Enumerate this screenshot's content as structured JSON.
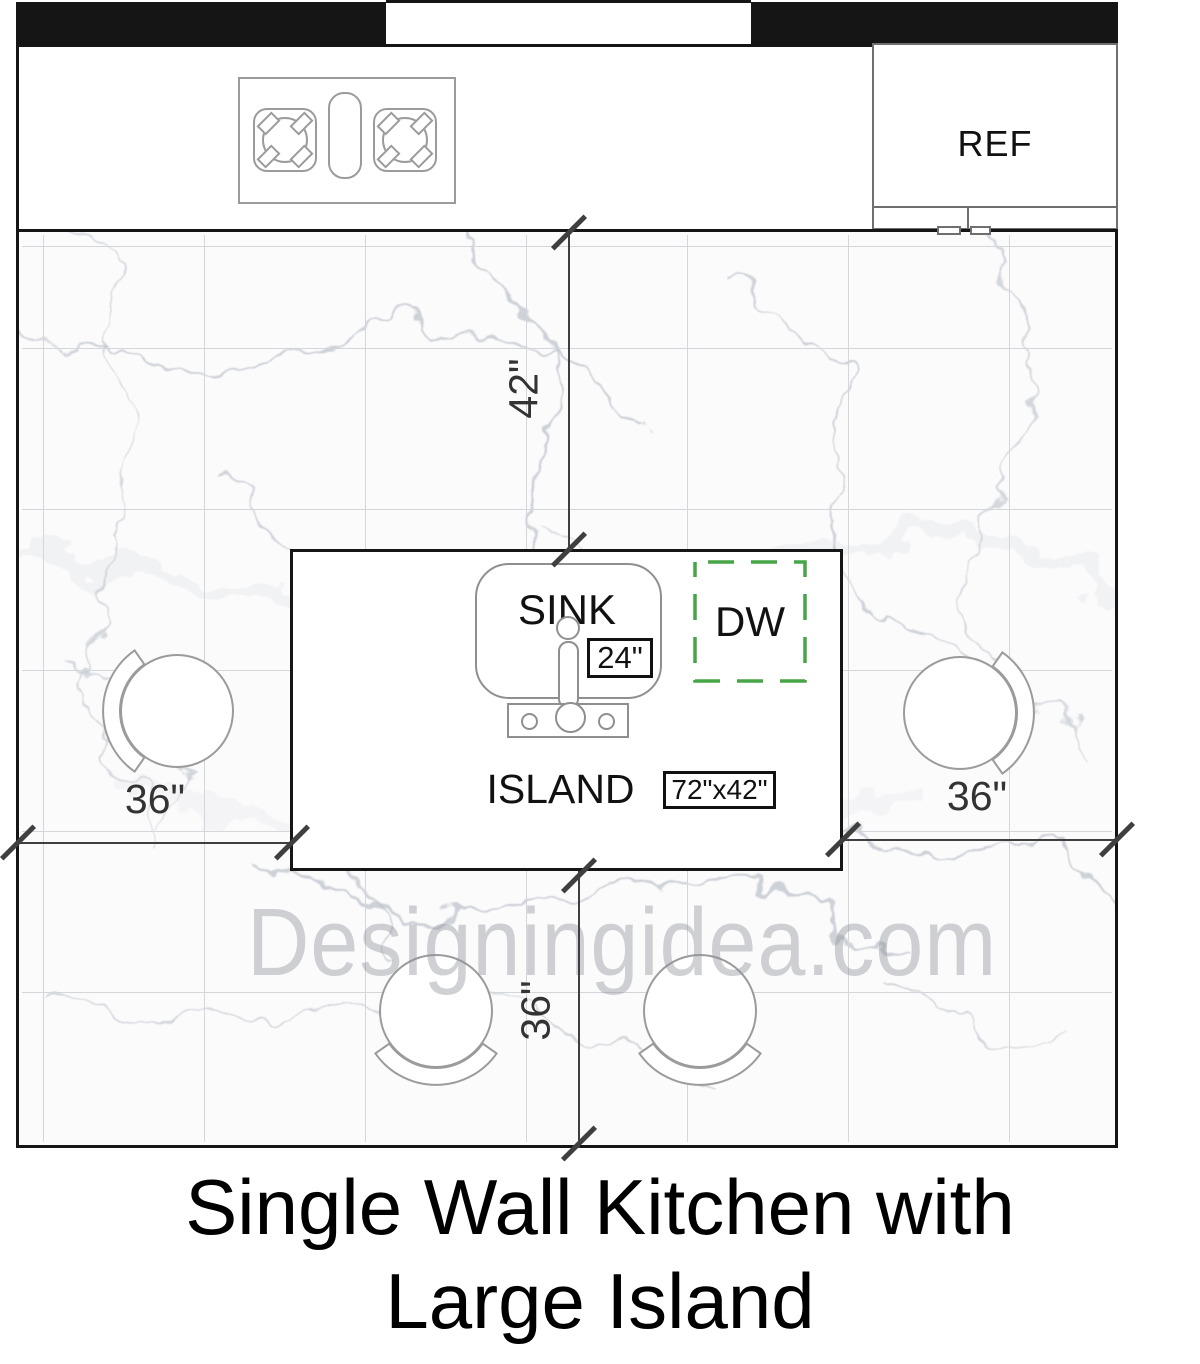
{
  "title": {
    "line1": "Single Wall Kitchen with",
    "line2": "Large Island"
  },
  "watermark": "Designingidea.com",
  "labels": {
    "fridge": "REF",
    "sink": "SINK",
    "dishwasher": "DW",
    "island": "ISLAND"
  },
  "dimensions": {
    "counter_to_island": "42\"",
    "left_clearance": "36\"",
    "right_clearance": "36\"",
    "seating_clearance": "36\"",
    "sink_width": "24\"",
    "island_size": "72\"x42\""
  },
  "colors": {
    "wall": "#151515",
    "dishwasher_accent": "#46a546",
    "dimension_gray": "#3f3f3f",
    "fixture_outline": "#9b9b9b",
    "tile_line": "#d3d6da",
    "watermark_gray": "#8c9198"
  }
}
